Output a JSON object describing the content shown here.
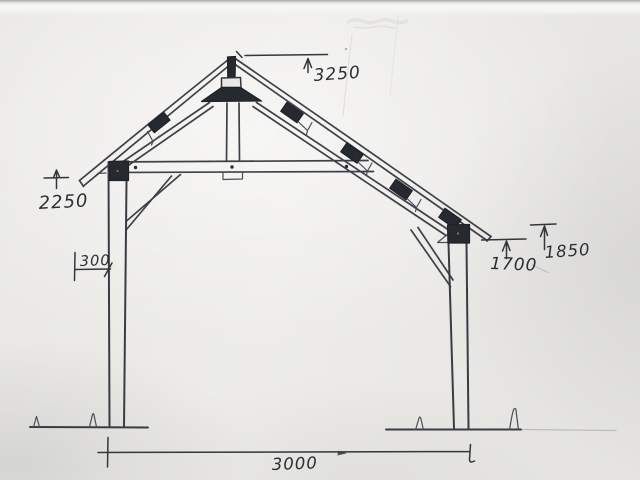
{
  "sketch": {
    "description": "hand-drawn timber frame truss elevation on paper",
    "dimensions": {
      "apex_height": "3250",
      "left_eave_height": "2250",
      "post_offset": "300",
      "right_underside_height": "1700",
      "right_eave_height": "1850",
      "span": "3000"
    },
    "colors": {
      "paper": "#eae9e6",
      "ink": "#3d4147",
      "connector_fill": "#262a2f"
    }
  }
}
